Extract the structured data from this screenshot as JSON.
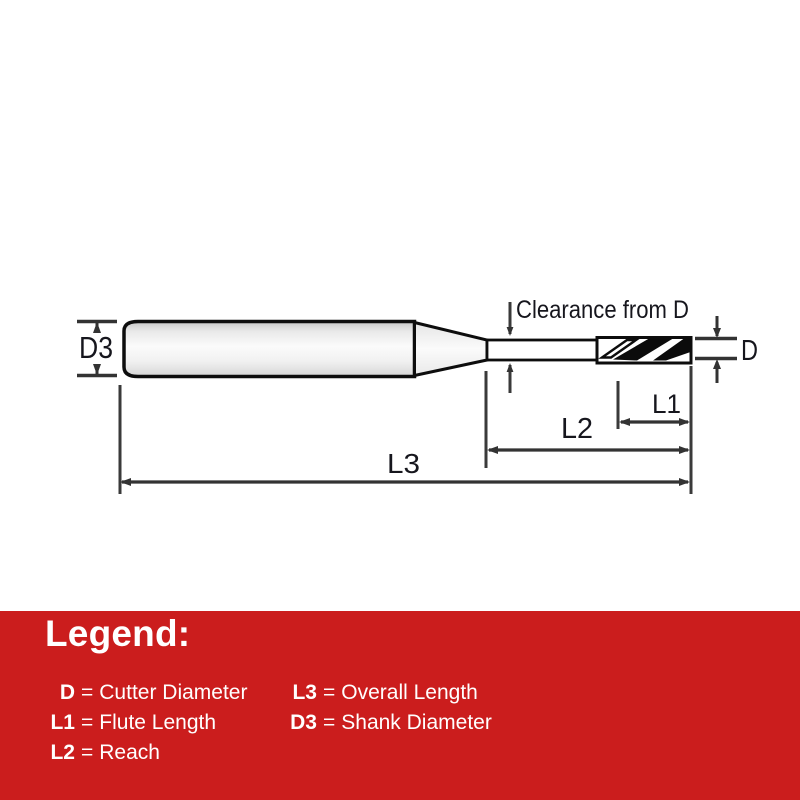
{
  "diagram": {
    "labels": {
      "shank_diameter": "D3",
      "cutter_diameter": "D",
      "flute_length": "L1",
      "reach": "L2",
      "overall_length": "L3",
      "clearance_note": "Clearance from D"
    },
    "line_color": "#333333",
    "outline_color": "#0d0d0d",
    "label_color": "#16161d"
  },
  "legend": {
    "title": "Legend:",
    "equals": "=",
    "background_color": "#CB1D1D",
    "text_color": "#FFFFFF",
    "entries": [
      {
        "term": "D",
        "definition": "Cutter Diameter"
      },
      {
        "term": "L1",
        "definition": "Flute Length"
      },
      {
        "term": "L2",
        "definition": "Reach"
      },
      {
        "term": "L3",
        "definition": "Overall Length"
      },
      {
        "term": "D3",
        "definition": "Shank Diameter"
      }
    ]
  }
}
